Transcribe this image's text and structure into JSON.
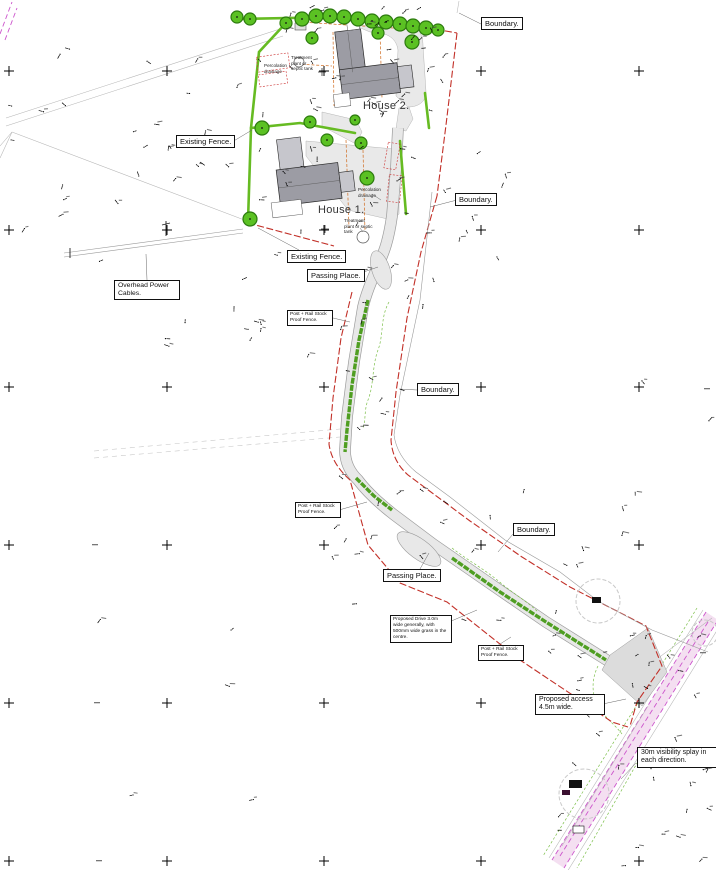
{
  "labels": {
    "boundary_top": "Boundary.",
    "existing_fence_1": "Existing Fence.",
    "boundary_right": "Boundary.",
    "existing_fence_2": "Existing Fence.",
    "passing_place_1": "Passing Place.",
    "overhead_power": "Overhead Power Cables.",
    "post_rail_1": "Post + Rail Stock Proof Fence.",
    "boundary_mid": "Boundary.",
    "post_rail_2": "Post + Rail Stock Proof Fence.",
    "boundary_low": "Boundary.",
    "passing_place_2": "Passing Place.",
    "proposed_drive": "Proposed Drive 3.0m wide generally, with 500mm wide grass in the centre.",
    "post_rail_3": "Post + Rail Stock Proof Fence.",
    "proposed_access": "Proposed access 4.5m wide.",
    "visibility_splay": "30m visibility splay in each direction."
  },
  "annotations": {
    "house_1": "House 1.",
    "house_2": "House 2.",
    "percolation_1": "Percolation drainage",
    "treatment_1": "Treatment plant or septic tank",
    "percolation_2": "Percolation drainage",
    "treatment_2": "Treatment plant or septic tank"
  },
  "colors": {
    "red": "#c23028",
    "green": "#66bb22",
    "tree": "#5bc123",
    "grass": "#4f9e22",
    "orange": "#cf6a1e",
    "magenta": "#cc55cc",
    "pink": "#f3dcef",
    "drive": "#e8e8e8"
  }
}
